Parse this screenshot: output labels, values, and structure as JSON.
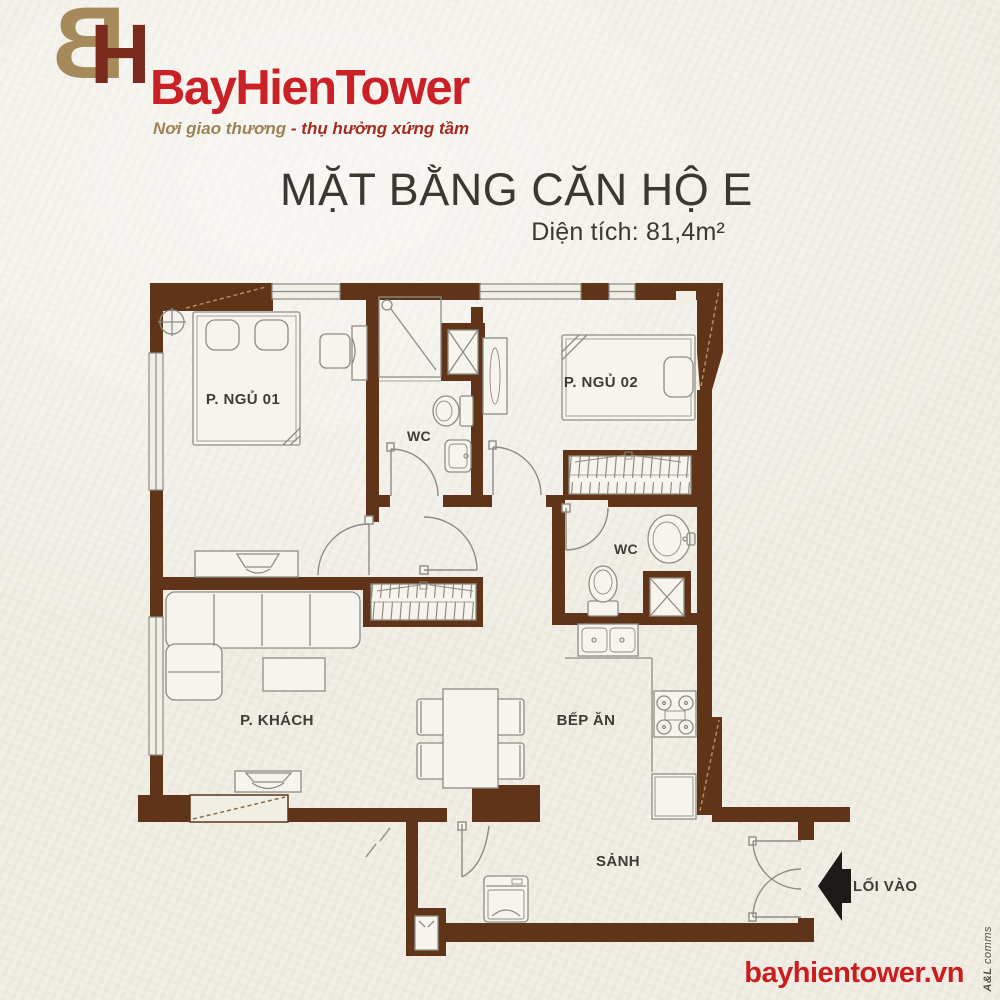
{
  "brand": {
    "monogram": {
      "b": "B",
      "h": "H"
    },
    "name": "BayHienTower",
    "tagline": {
      "left": "Nơi giao thương",
      "sep": " - ",
      "right": "thụ hưởng xứng tầm"
    },
    "website": "bayhientower.vn",
    "credit": {
      "bold": "A&L",
      "rest": "comms"
    }
  },
  "title": {
    "main": "MẶT BẰNG CĂN HỘ E",
    "area": "Diện tích: 81,4m²"
  },
  "plan": {
    "rooms": {
      "bedroom1": "P. NGỦ 01",
      "wc1": "WC",
      "bedroom2": "P. NGỦ 02",
      "wc2": "WC",
      "living": "P. KHÁCH",
      "kitchen": "BẾP ĂN",
      "hall": "SẢNH",
      "entrance": "LỐI VÀO"
    }
  },
  "colors": {
    "wall": "#5f3418",
    "line": "#8d8c85",
    "paper": "#f1eee6",
    "furniture_fill": "#f6f4ec",
    "dash": "#b08d65",
    "arrow": "#1d1b18",
    "brand_red": "#cb2026",
    "brand_tan": "#a68a5c",
    "text": "#3d3c35"
  }
}
